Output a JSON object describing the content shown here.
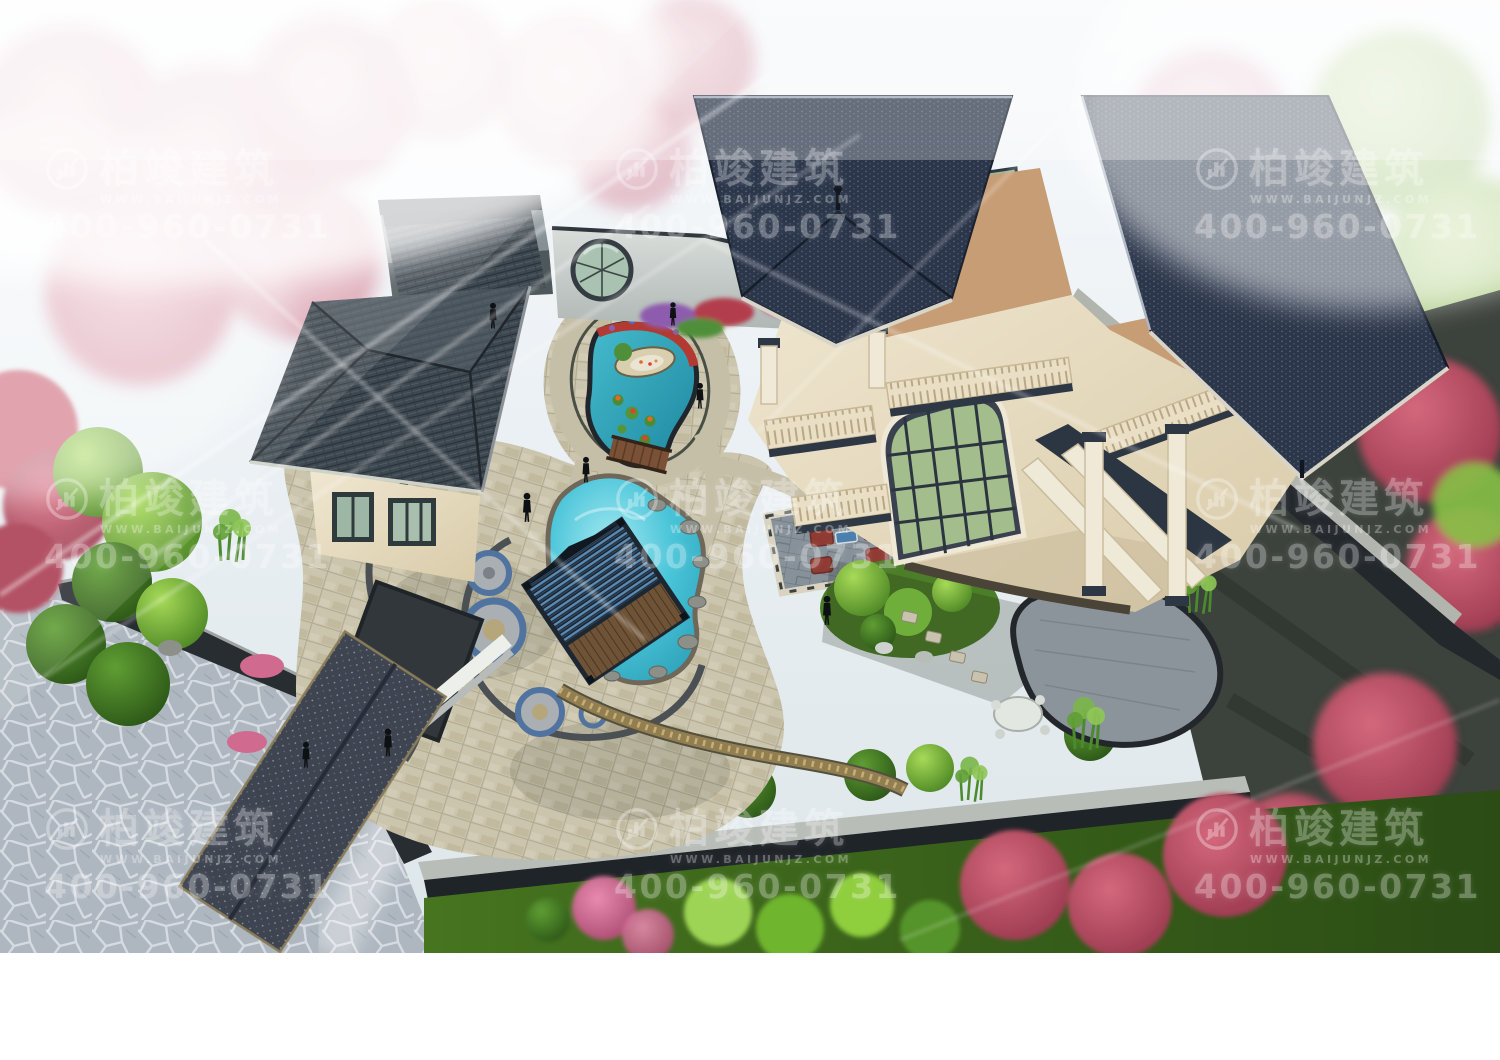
{
  "scene": {
    "description": "Aerial 3D architectural rendering of a European-style villa with Chinese courtyard, swimming pool, koi pond, pavilion and gardens surrounded by pink blossom trees"
  },
  "watermark": {
    "logo_icon": "baijun-architecture-logo-icon",
    "brand": "柏竣建筑",
    "website": "WWW.BAIJUNJZ.COM",
    "phone": "400-960-0731",
    "color": "#ffffff",
    "opacity": 0.32,
    "tile_count": 9
  },
  "palette": {
    "sky_haze": "#eef3f6",
    "blossom_pink": "#d98fa0",
    "tree_red": "#b8475c",
    "tree_green": "#5f9e33",
    "bamboo_green": "#7ab648",
    "roof_navy": "#2b3649",
    "roof_slate": "#3e4850",
    "wall_cream": "#e9dfc8",
    "terrace_terracotta": "#c79d75",
    "water_turquoise": "#3fc0d4",
    "water_teal": "#2aa6bd",
    "paving_beige": "#cbc5ae",
    "flagstone_gray": "#aeb7c0",
    "patio_gray": "#87919a",
    "lawn_green": "#3f6a1e",
    "wall_charcoal": "#23282d",
    "ottoman_red": "#8f3a32"
  }
}
